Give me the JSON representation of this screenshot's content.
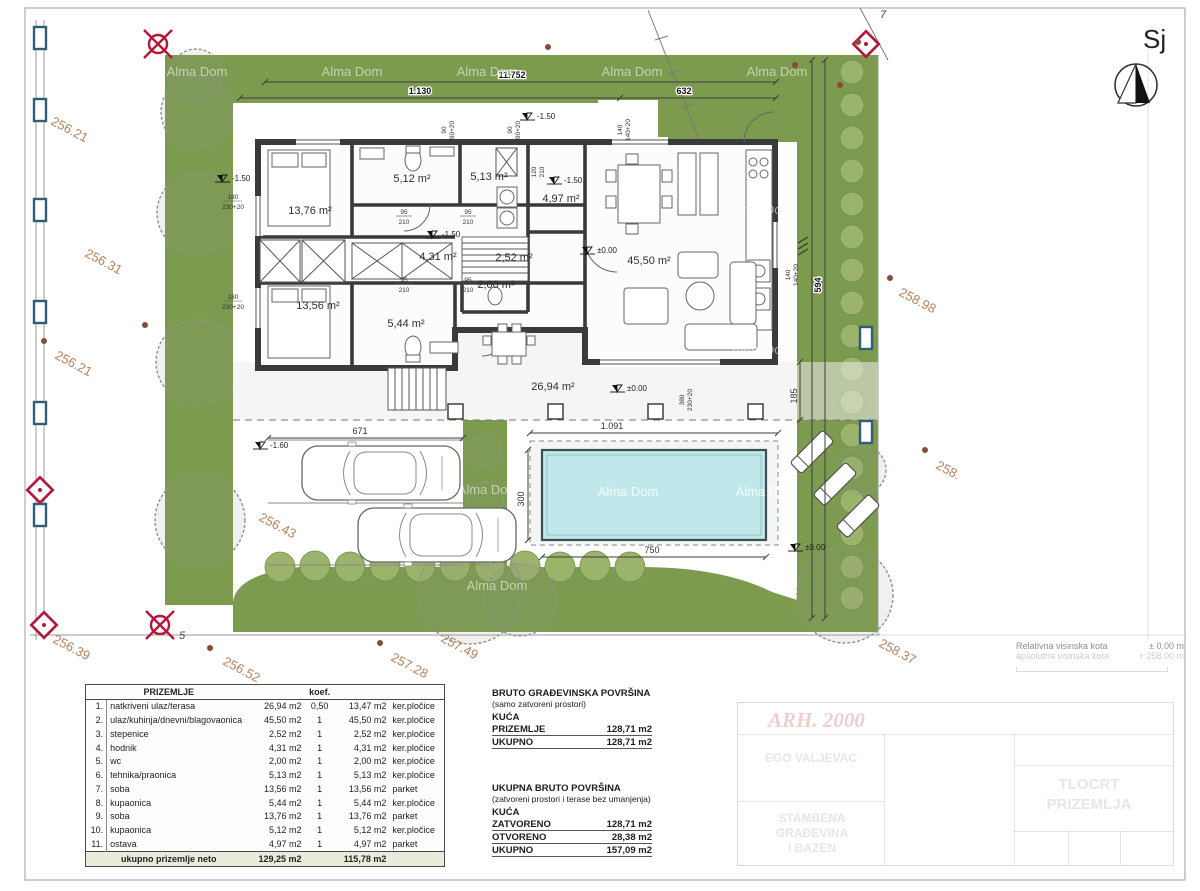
{
  "north": {
    "label": "Sj"
  },
  "watermarks": {
    "text": "Alma Dom",
    "instances": [
      {
        "x": 197,
        "y": 76,
        "style": "green"
      },
      {
        "x": 352,
        "y": 76,
        "style": "green"
      },
      {
        "x": 487,
        "y": 76,
        "style": "green"
      },
      {
        "x": 632,
        "y": 76,
        "style": "green"
      },
      {
        "x": 777,
        "y": 76,
        "style": "green"
      },
      {
        "x": 762,
        "y": 214,
        "style": "green"
      },
      {
        "x": 762,
        "y": 354,
        "style": "green"
      },
      {
        "x": 488,
        "y": 494,
        "style": "green"
      },
      {
        "x": 497,
        "y": 590,
        "style": "green"
      },
      {
        "x": 628,
        "y": 496,
        "style": "pool"
      },
      {
        "x": 766,
        "y": 496,
        "style": "pool"
      }
    ]
  },
  "survey": {
    "elevations": [
      {
        "t": "256.21",
        "x": 50,
        "y": 124
      },
      {
        "t": "256.31",
        "x": 84,
        "y": 256
      },
      {
        "t": "256.21",
        "x": 54,
        "y": 358
      },
      {
        "t": "256.43",
        "x": 258,
        "y": 520
      },
      {
        "t": "256.39",
        "x": 52,
        "y": 642
      },
      {
        "t": "256.52",
        "x": 222,
        "y": 664
      },
      {
        "t": "257.28",
        "x": 390,
        "y": 660
      },
      {
        "t": "257.49",
        "x": 440,
        "y": 641
      },
      {
        "t": "258.37",
        "x": 878,
        "y": 646
      },
      {
        "t": "258.98",
        "x": 898,
        "y": 295
      },
      {
        "t": "258.",
        "x": 935,
        "y": 468
      }
    ],
    "dots": [
      {
        "x": 44,
        "y": 341
      },
      {
        "x": 145,
        "y": 325
      },
      {
        "x": 548,
        "y": 47
      },
      {
        "x": 795,
        "y": 65
      },
      {
        "x": 858,
        "y": 42
      },
      {
        "x": 210,
        "y": 648
      },
      {
        "x": 380,
        "y": 643
      },
      {
        "x": 890,
        "y": 278
      },
      {
        "x": 925,
        "y": 450
      },
      {
        "x": 840,
        "y": 85
      }
    ]
  },
  "notes": {
    "marker5": "5",
    "corner7": "7"
  },
  "dims": {
    "top_total": "11.752",
    "top_left": "1.130",
    "top_right": "632",
    "right_strip": "594",
    "pool_top": "1.091",
    "pool_bottom": "750",
    "pool_side": "300",
    "parking": "671",
    "terrace_side": "185",
    "w90": "90",
    "w90p": "90+20",
    "w140": "140",
    "w140p": "140+20",
    "w180": "180",
    "w230p": "230+20",
    "w380": "380",
    "d95": "95",
    "d210": "210",
    "d120": "120"
  },
  "levels": {
    "zero": "±0.00",
    "m150": "-1.50",
    "m160": "-1.60"
  },
  "plan": {
    "room_labels": [
      {
        "label": "13,76 m²",
        "x": 310,
        "y": 214
      },
      {
        "label": "5,12 m²",
        "x": 412,
        "y": 182
      },
      {
        "label": "5,13 m²",
        "x": 489,
        "y": 180
      },
      {
        "label": "4,97 m²",
        "x": 561,
        "y": 202
      },
      {
        "label": "4,31 m²",
        "x": 438,
        "y": 260
      },
      {
        "label": "2,52 m²",
        "x": 514,
        "y": 261
      },
      {
        "label": "2,00 m²",
        "x": 496,
        "y": 288
      },
      {
        "label": "13,56 m²",
        "x": 318,
        "y": 309
      },
      {
        "label": "5,44 m²",
        "x": 406,
        "y": 327
      },
      {
        "label": "45,50 m²",
        "x": 649,
        "y": 264
      },
      {
        "label": "26,94 m²",
        "x": 553,
        "y": 390
      }
    ]
  },
  "schedule": {
    "title": "PRIZEMLJE",
    "koef_header": "koef.",
    "rows": [
      [
        "1.",
        "natkriveni ulaz/terasa",
        "26,94 m2",
        "0,50",
        "13,47 m2",
        "ker.pločice"
      ],
      [
        "2.",
        "ulaz/kuhinja/dnevni/blagovaonica",
        "45,50 m2",
        "1",
        "45,50 m2",
        "ker.pločice"
      ],
      [
        "3.",
        "stepenice",
        "2,52 m2",
        "1",
        "2,52 m2",
        "ker.pločice"
      ],
      [
        "4.",
        "hodnik",
        "4,31 m2",
        "1",
        "4,31 m2",
        "ker.pločice"
      ],
      [
        "5.",
        "wc",
        "2,00 m2",
        "1",
        "2,00 m2",
        "ker.pločice"
      ],
      [
        "6.",
        "tehnika/praonica",
        "5,13 m2",
        "1",
        "5,13 m2",
        "ker.pločice"
      ],
      [
        "7.",
        "soba",
        "13,56 m2",
        "1",
        "13,56 m2",
        "parket"
      ],
      [
        "8.",
        "kupaonica",
        "5,44 m2",
        "1",
        "5,44 m2",
        "ker.pločice"
      ],
      [
        "9.",
        "soba",
        "13,76 m2",
        "1",
        "13,76 m2",
        "parket"
      ],
      [
        "10.",
        "kupaonica",
        "5,12 m2",
        "1",
        "5,12 m2",
        "ker.pločice"
      ],
      [
        "11.",
        "ostava",
        "4,97 m2",
        "1",
        "4,97 m2",
        "parket"
      ]
    ],
    "total_label": "ukupno prizemlje neto",
    "total_net": "129,25 m2",
    "total_weighted": "115,78 m2"
  },
  "summary": {
    "s1_title": "BRUTO GRAĐEVINSKA POVRŠINA",
    "s1_sub": "(samo zatvoreni prostori)",
    "s1_group": "KUĆA",
    "s1_rows": [
      {
        "label": "PRIZEMLJE",
        "value": "128,71 m2"
      },
      {
        "label": "UKUPNO",
        "value": "128,71 m2"
      }
    ],
    "s2_title": "UKUPNA BRUTO POVRŠINA",
    "s2_sub": "(zatvoreni prostori i terase bez umanjenja)",
    "s2_group": "KUĆA",
    "s2_rows": [
      {
        "label": "ZATVORENO",
        "value": "128,71 m2"
      },
      {
        "label": "OTVORENO",
        "value": "28,38 m2"
      },
      {
        "label": "UKUPNO",
        "value": "157,09 m2"
      }
    ]
  },
  "legend": {
    "rel_label": "Relativna visinska kota",
    "rel_value": "± 0.00 m",
    "abs_label": "apsolutna visinska kota",
    "abs_value": "+ 258.00 m"
  },
  "title_block": {
    "brand": "ARH. 2000",
    "investor": "EGO VALJEVAC",
    "project_line1": "STAMBENA GRAĐEVINA",
    "project_line2": "I BAZEN",
    "drawing_line1": "TLOCRT",
    "drawing_line2": "PRIZEMLJA"
  }
}
